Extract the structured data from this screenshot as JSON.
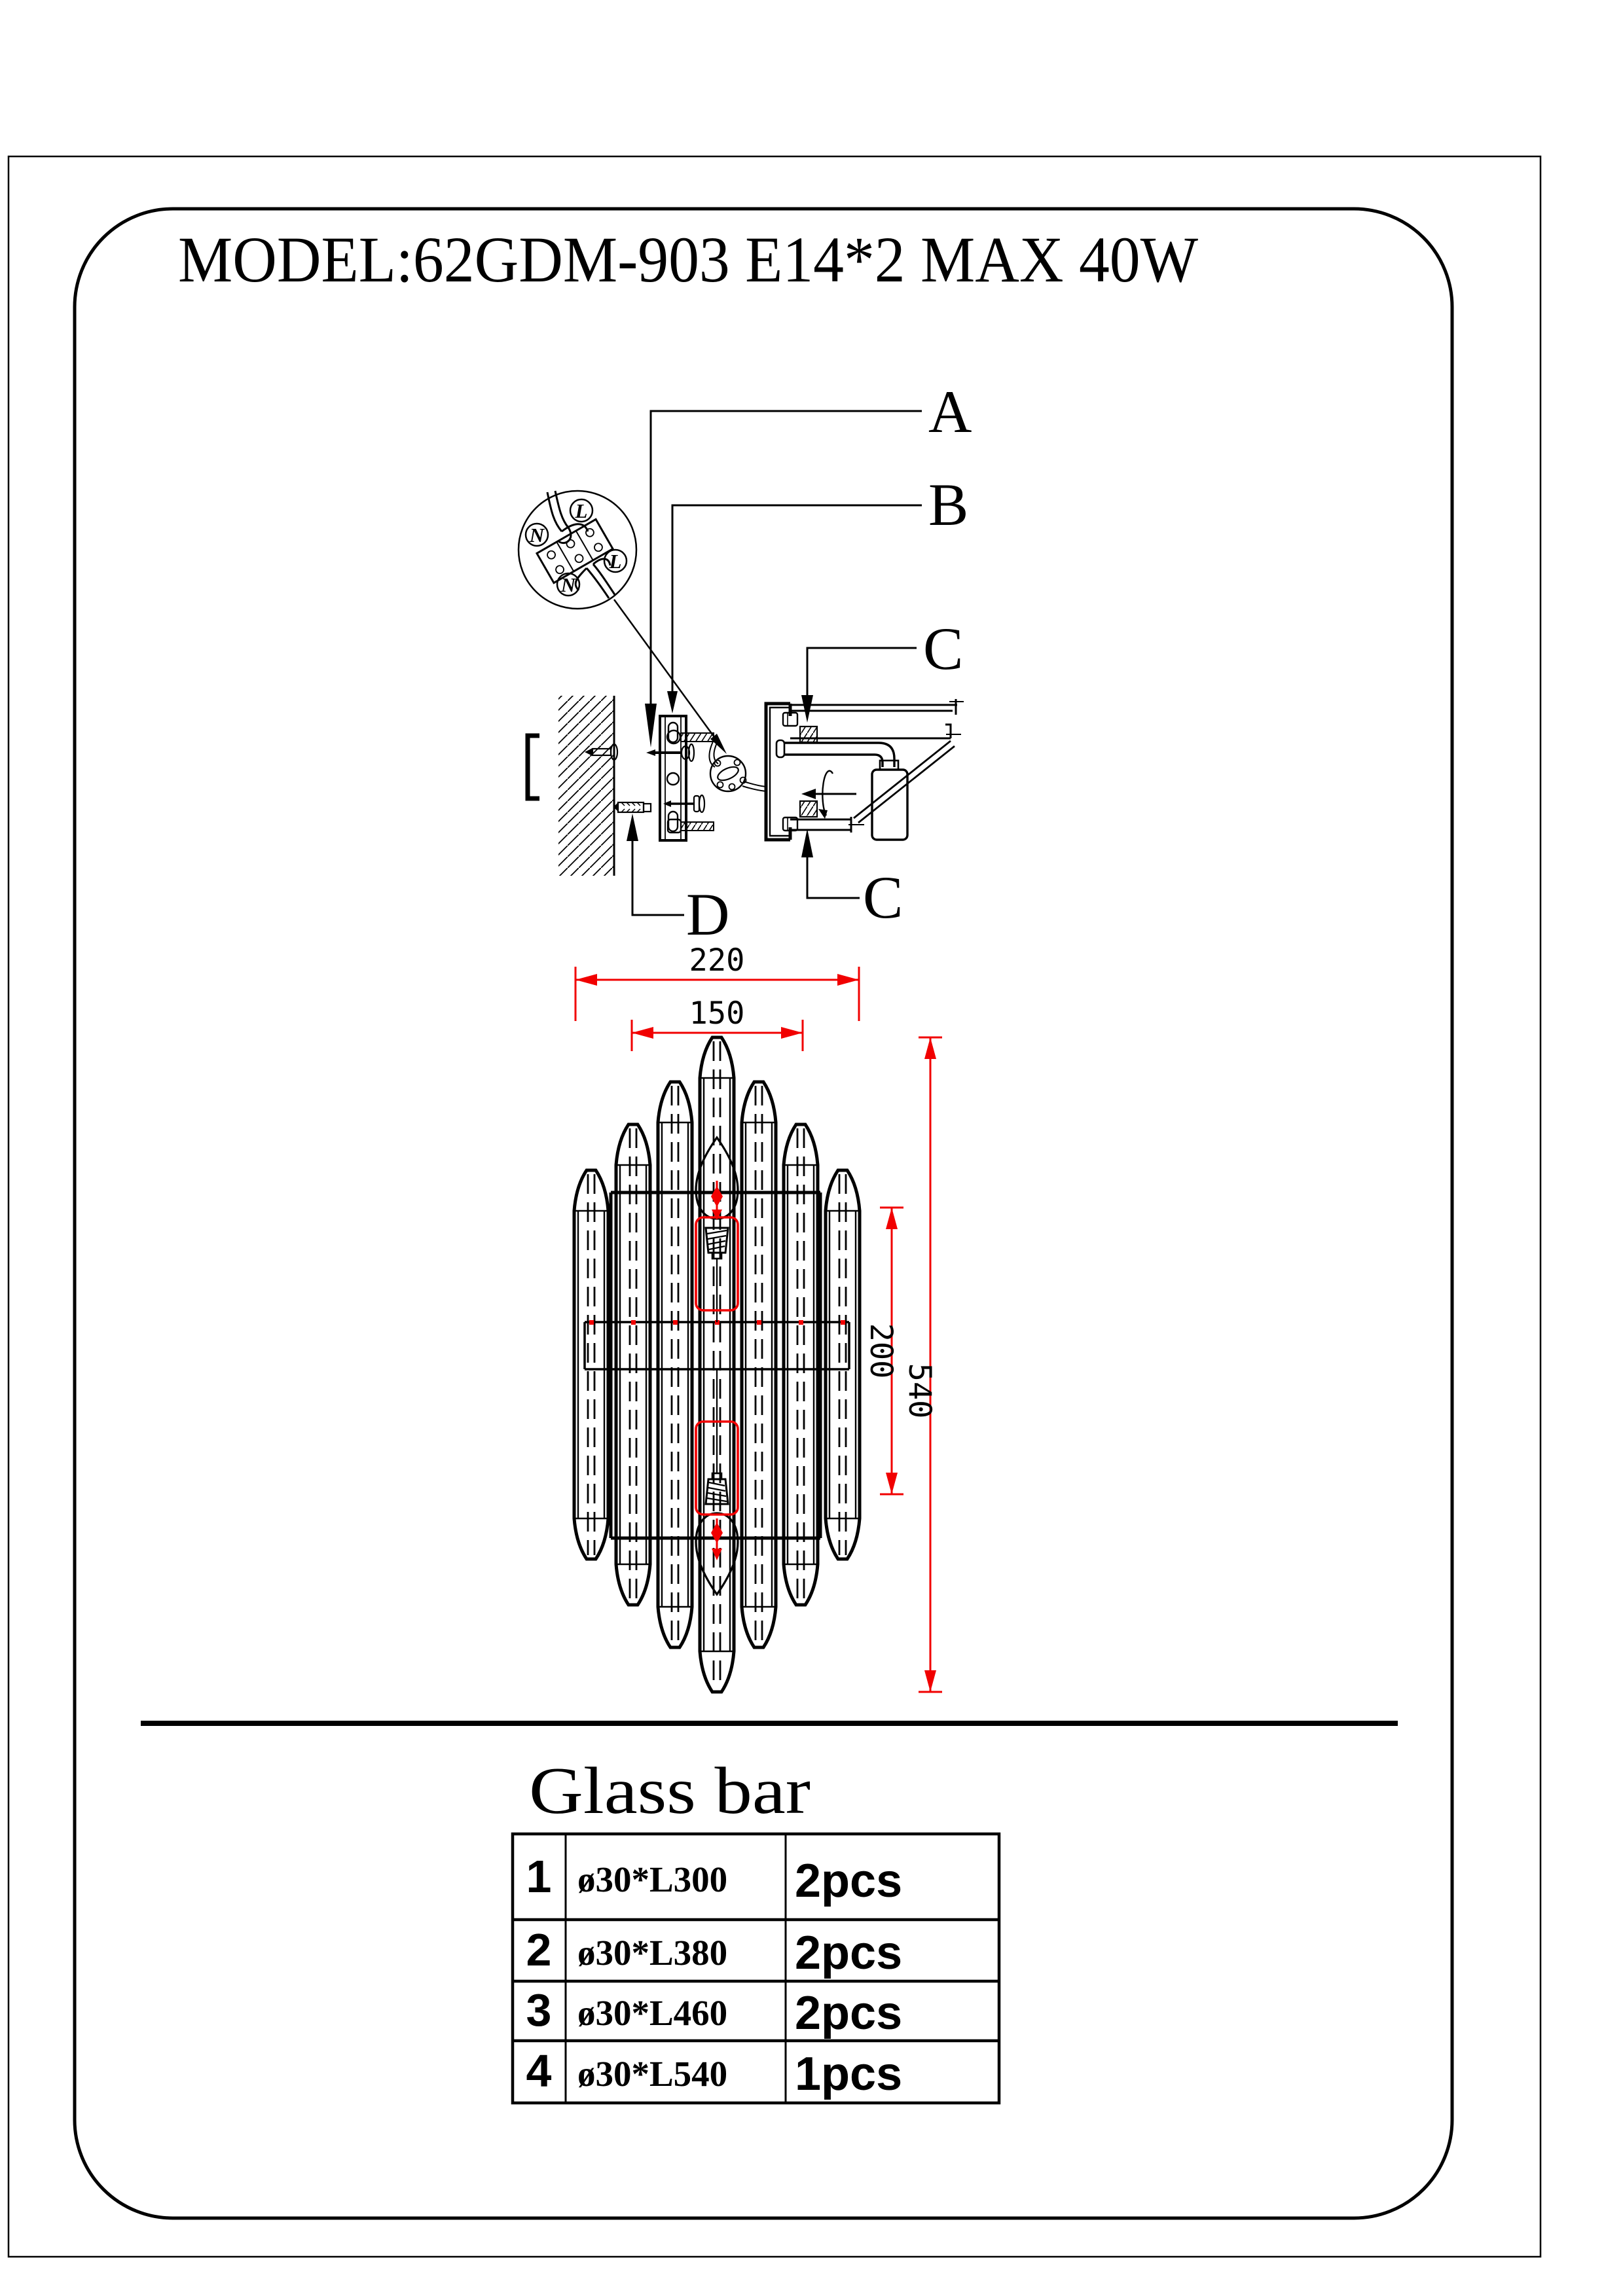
{
  "page": {
    "title": "MODEL:62GDM-903 E14*2 MAX 40W"
  },
  "colors": {
    "line": "#000000",
    "dimension": "#f10000"
  },
  "install_diagram": {
    "callouts": {
      "a": "A",
      "b": "B",
      "c_top": "C",
      "c_bottom": "C",
      "d": "D"
    },
    "wiring_labels": {
      "n_top": "N",
      "l_top": "L",
      "l_right": "L",
      "n_bottom": "N"
    }
  },
  "dimensions": {
    "overall_width": "220",
    "inner_width": "150",
    "lamp_spacing": "200",
    "overall_height": "540"
  },
  "parts_table": {
    "title": "Glass bar",
    "rows": [
      {
        "no": "1",
        "spec": "ø30*L300",
        "qty": "2pcs"
      },
      {
        "no": "2",
        "spec": "ø30*L380",
        "qty": "2pcs"
      },
      {
        "no": "3",
        "spec": "ø30*L460",
        "qty": "2pcs"
      },
      {
        "no": "4",
        "spec": "ø30*L540",
        "qty": "1pcs"
      }
    ]
  }
}
